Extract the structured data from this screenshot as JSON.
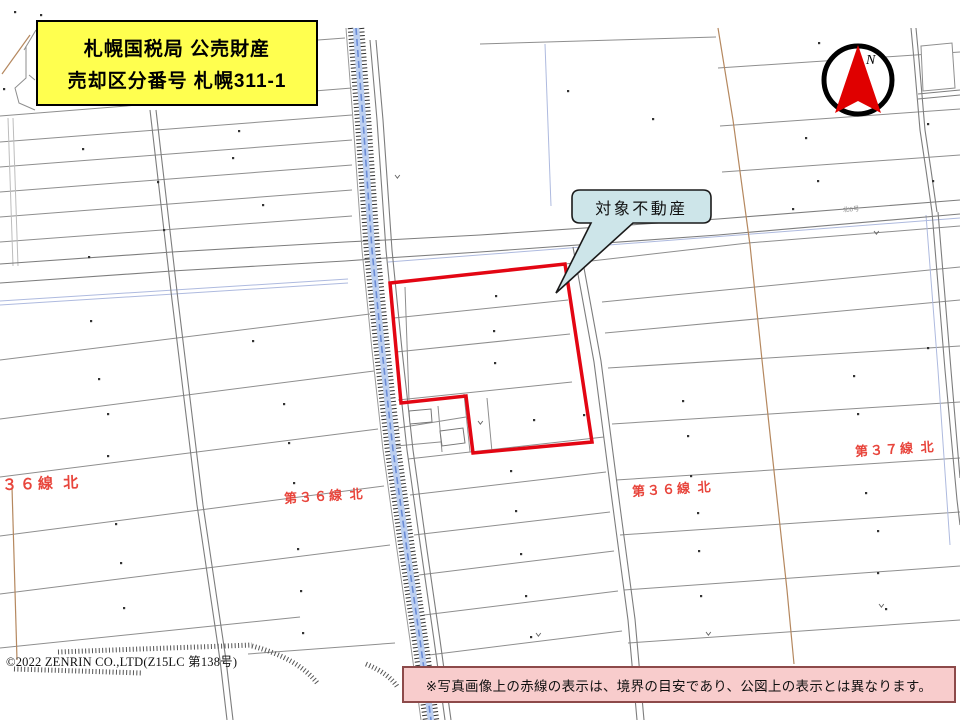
{
  "title_box": {
    "line1": "札幌国税局 公売財産",
    "line2": "売却区分番号 札幌311-1"
  },
  "compass": {
    "north_label": "N"
  },
  "callout": {
    "label": "対象不動産"
  },
  "road_labels": {
    "left": "３６線 北",
    "center": "第３６線 北",
    "east": "第３６線 北",
    "far_east": "第３７線 北"
  },
  "small_road_label": "北6号",
  "copyright": "©2022 ZENRIN CO.,LTD(Z15LC 第138号)",
  "disclaimer": "※写真画像上の赤線の表示は、境界の目安であり、公図上の表示とは異なります。",
  "colors": {
    "property_outline": "#e30613",
    "road_label_red": "#e8453c",
    "title_bg": "#ffff4f",
    "callout_bg": "#cde5e9",
    "disclaimer_bg": "#f8cccc",
    "compass_needle": "#e00000",
    "stream_blue": "#b9cdf0"
  }
}
